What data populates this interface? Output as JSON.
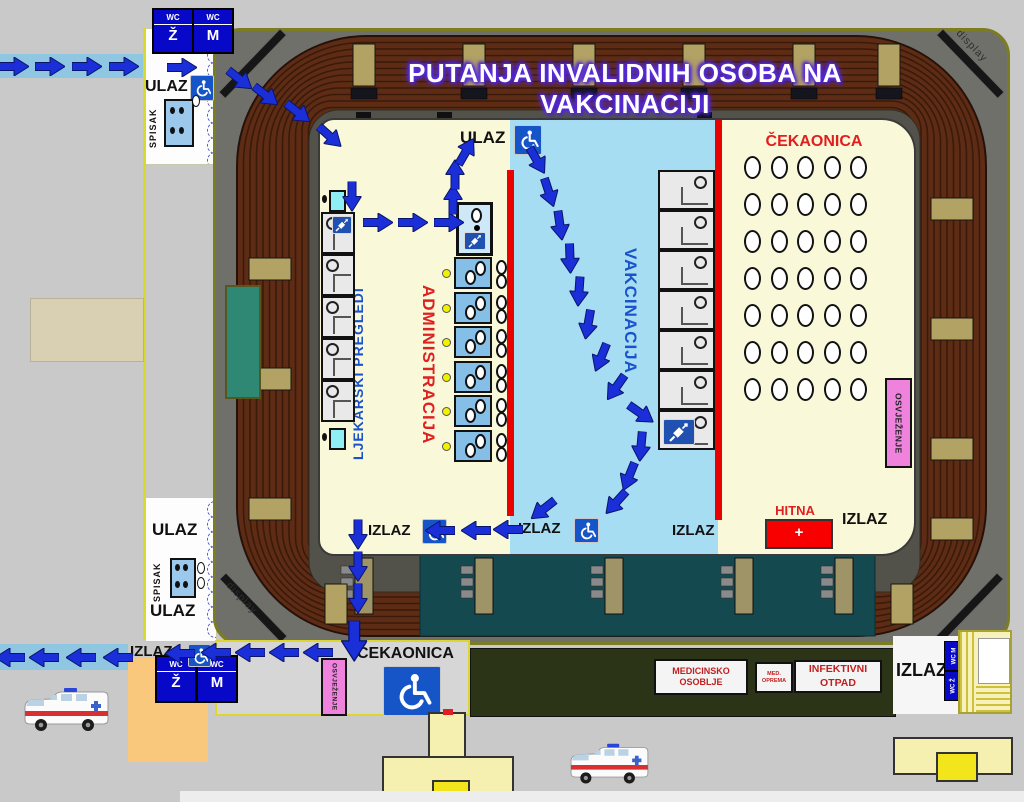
{
  "title": "PUTANJA INVALIDNIH OSOBA NA VAKCINACIJI",
  "labels": {
    "ulaz": "ULAZ",
    "izlaz": "IZLAZ",
    "spisak": "SPISAK",
    "wc": "WC",
    "wc_z": "Ž",
    "wc_m": "M",
    "cekaonica": "ČEKAONICA",
    "ljekarski": "LJEKARSKI PREGLEDI",
    "administracija": "ADMINISTRACIJA",
    "vakcinacija": "VAKCINACIJA",
    "osvjezenje": "OSVJEŽENJE",
    "hitna": "HITNA",
    "plus": "+",
    "medicinsko_1": "MEDICINSKO",
    "medicinsko_2": "OSOBLJE",
    "med_oprema_1": "MED.",
    "med_oprema_2": "OPREMA",
    "infektivni": "INFEKTIVNI OTPAD",
    "display": "display"
  },
  "colors": {
    "arrow": "#1b2fd8",
    "red_line": "#e80202",
    "floor_yellow": "#f9f8d8",
    "floor_blue": "#a6ddf3",
    "sign_blue": "#0808c8",
    "pink": "#ee82dd",
    "emergency_red": "#f80000",
    "stage_teal": "#14494f",
    "dark_green": "#2c3418"
  },
  "floor": {
    "waiting": {
      "rows": 7,
      "cols": 5
    },
    "medical_booths": 5,
    "admin_booths": 6,
    "vaccination_booths": 7,
    "scallops": 9
  },
  "arrows": [
    [
      14,
      66,
      0
    ],
    [
      50,
      66,
      0
    ],
    [
      87,
      66,
      0
    ],
    [
      124,
      66,
      0
    ],
    [
      182,
      67,
      0
    ],
    [
      240,
      79,
      38
    ],
    [
      266,
      95,
      38
    ],
    [
      298,
      112,
      38
    ],
    [
      330,
      136,
      42
    ],
    [
      352,
      196,
      90
    ],
    [
      378,
      222,
      0
    ],
    [
      413,
      222,
      0
    ],
    [
      449,
      222,
      0
    ],
    [
      453,
      199,
      -90
    ],
    [
      455,
      174,
      -90
    ],
    [
      466,
      151,
      -60
    ],
    [
      537,
      160,
      60
    ],
    [
      549,
      192,
      72
    ],
    [
      560,
      225,
      82
    ],
    [
      570,
      258,
      88
    ],
    [
      579,
      291,
      94
    ],
    [
      588,
      324,
      100
    ],
    [
      601,
      357,
      112
    ],
    [
      616,
      387,
      125
    ],
    [
      641,
      413,
      35
    ],
    [
      641,
      446,
      95
    ],
    [
      629,
      476,
      112
    ],
    [
      616,
      502,
      132
    ],
    [
      543,
      509,
      142
    ],
    [
      508,
      529,
      180
    ],
    [
      476,
      530,
      180
    ],
    [
      440,
      530,
      180
    ],
    [
      358,
      534,
      90
    ],
    [
      358,
      566,
      90
    ],
    [
      358,
      598,
      90
    ],
    [
      354,
      641,
      90,
      1.35
    ],
    [
      318,
      652,
      180
    ],
    [
      284,
      652,
      180
    ],
    [
      250,
      652,
      180
    ],
    [
      216,
      652,
      180
    ],
    [
      180,
      653,
      180
    ],
    [
      118,
      657,
      180
    ],
    [
      81,
      657,
      180
    ],
    [
      44,
      657,
      180
    ],
    [
      10,
      657,
      180
    ]
  ]
}
